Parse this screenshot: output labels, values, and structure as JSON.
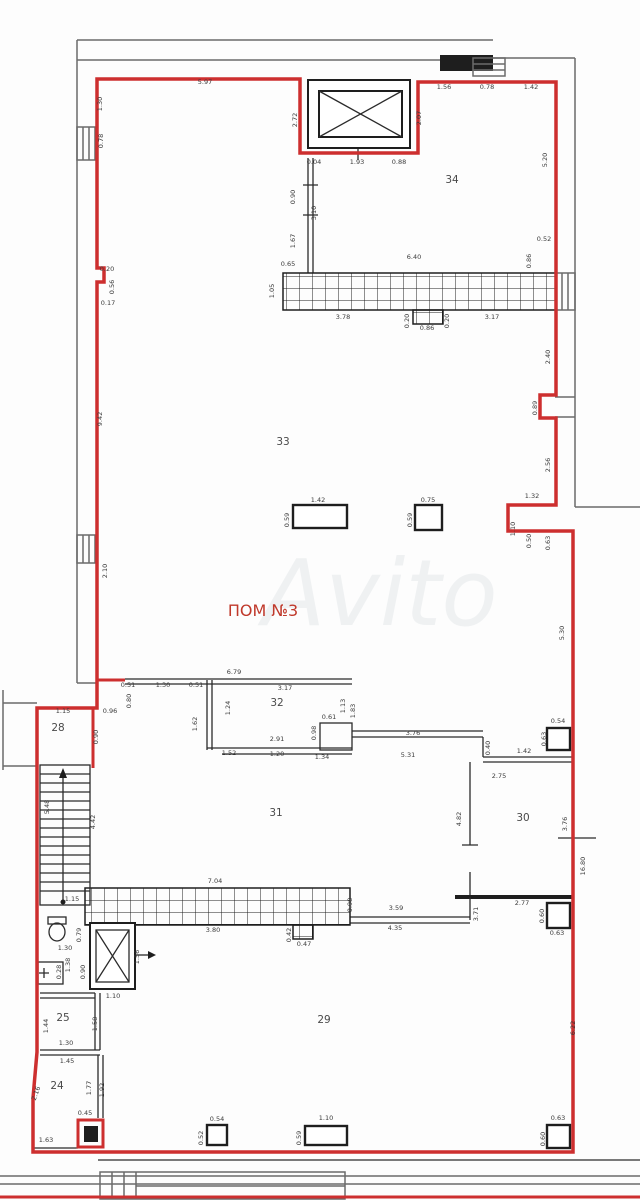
{
  "plan": {
    "title": "ПОМ №3",
    "watermark": "Avito",
    "colors": {
      "boundary": "#cd2f2f",
      "walls": "#2b2b2b",
      "outer": "#6b6b6b"
    },
    "rooms": [
      "24",
      "25",
      "28",
      "29",
      "30",
      "31",
      "32",
      "33",
      "34"
    ],
    "labels": [
      {
        "t": "5.97",
        "x": 205,
        "y": 84
      },
      {
        "t": "1.30",
        "x": 102,
        "y": 104,
        "r": -90
      },
      {
        "t": "0.78",
        "x": 103,
        "y": 141,
        "r": -90
      },
      {
        "t": "2.72",
        "x": 297,
        "y": 120,
        "r": -90
      },
      {
        "t": "1.56",
        "x": 444,
        "y": 89
      },
      {
        "t": "0.78",
        "x": 487,
        "y": 89
      },
      {
        "t": "1.42",
        "x": 531,
        "y": 89
      },
      {
        "t": "2.07",
        "x": 421,
        "y": 118,
        "r": -90
      },
      {
        "t": "0.04",
        "x": 314,
        "y": 164
      },
      {
        "t": "1.93",
        "x": 357,
        "y": 164
      },
      {
        "t": "0.88",
        "x": 399,
        "y": 164
      },
      {
        "t": "34",
        "x": 452,
        "y": 183,
        "kind": "room"
      },
      {
        "t": "5.20",
        "x": 547,
        "y": 160,
        "r": -90
      },
      {
        "t": "0.90",
        "x": 295,
        "y": 197,
        "r": -90
      },
      {
        "t": "3.10",
        "x": 316,
        "y": 213,
        "r": -90
      },
      {
        "t": "1.67",
        "x": 295,
        "y": 241,
        "r": -90
      },
      {
        "t": "0.65",
        "x": 288,
        "y": 266
      },
      {
        "t": "6.40",
        "x": 414,
        "y": 259
      },
      {
        "t": "0.86",
        "x": 531,
        "y": 261,
        "r": -90
      },
      {
        "t": "0.52",
        "x": 544,
        "y": 241
      },
      {
        "t": "1.05",
        "x": 274,
        "y": 291,
        "r": -90
      },
      {
        "t": "3.78",
        "x": 343,
        "y": 319
      },
      {
        "t": "0.20",
        "x": 409,
        "y": 321,
        "r": -90
      },
      {
        "t": "0.20",
        "x": 449,
        "y": 321,
        "r": -90
      },
      {
        "t": "0.86",
        "x": 427,
        "y": 330
      },
      {
        "t": "3.17",
        "x": 492,
        "y": 319
      },
      {
        "t": "2.40",
        "x": 550,
        "y": 357,
        "r": -90
      },
      {
        "t": "0.20",
        "x": 107,
        "y": 271
      },
      {
        "t": "0.56",
        "x": 114,
        "y": 287,
        "r": -90
      },
      {
        "t": "0.17",
        "x": 108,
        "y": 305
      },
      {
        "t": "9.42",
        "x": 102,
        "y": 419,
        "r": -90
      },
      {
        "t": "33",
        "x": 283,
        "y": 445,
        "kind": "room"
      },
      {
        "t": "1.42",
        "x": 318,
        "y": 502
      },
      {
        "t": "0.59",
        "x": 289,
        "y": 520,
        "r": -90
      },
      {
        "t": "0.75",
        "x": 428,
        "y": 502
      },
      {
        "t": "0.59",
        "x": 412,
        "y": 520,
        "r": -90
      },
      {
        "t": "0.89",
        "x": 537,
        "y": 408,
        "r": -90
      },
      {
        "t": "2.56",
        "x": 550,
        "y": 465,
        "r": -90
      },
      {
        "t": "1.32",
        "x": 532,
        "y": 498
      },
      {
        "t": "1.10",
        "x": 515,
        "y": 529,
        "r": -90
      },
      {
        "t": "0.50",
        "x": 531,
        "y": 541,
        "r": -90
      },
      {
        "t": "0.63",
        "x": 550,
        "y": 543,
        "r": -90
      },
      {
        "t": "2.10",
        "x": 107,
        "y": 571,
        "r": -90
      },
      {
        "t": "5.30",
        "x": 564,
        "y": 633,
        "r": -90
      },
      {
        "t": "6.79",
        "x": 234,
        "y": 674
      },
      {
        "t": "0.51",
        "x": 128,
        "y": 687
      },
      {
        "t": "1.30",
        "x": 163,
        "y": 687
      },
      {
        "t": "0.51",
        "x": 196,
        "y": 687
      },
      {
        "t": "0.80",
        "x": 131,
        "y": 701,
        "r": -90
      },
      {
        "t": "1.15",
        "x": 63,
        "y": 713
      },
      {
        "t": "28",
        "x": 58,
        "y": 731,
        "kind": "room"
      },
      {
        "t": "0.96",
        "x": 110,
        "y": 713
      },
      {
        "t": "0.90",
        "x": 98,
        "y": 737,
        "r": -90
      },
      {
        "t": "1.62",
        "x": 197,
        "y": 724,
        "r": -90
      },
      {
        "t": "1.24",
        "x": 230,
        "y": 708,
        "r": -90
      },
      {
        "t": "32",
        "x": 277,
        "y": 706,
        "kind": "room"
      },
      {
        "t": "3.17",
        "x": 285,
        "y": 690
      },
      {
        "t": "0.61",
        "x": 329,
        "y": 719
      },
      {
        "t": "1.13",
        "x": 345,
        "y": 706,
        "r": -90
      },
      {
        "t": "1.83",
        "x": 355,
        "y": 711,
        "r": -90
      },
      {
        "t": "0.98",
        "x": 316,
        "y": 733,
        "r": -90
      },
      {
        "t": "2.91",
        "x": 277,
        "y": 741
      },
      {
        "t": "1.52",
        "x": 229,
        "y": 755
      },
      {
        "t": "1.20",
        "x": 277,
        "y": 756
      },
      {
        "t": "1.34",
        "x": 322,
        "y": 759
      },
      {
        "t": "3.76",
        "x": 413,
        "y": 735
      },
      {
        "t": "5.31",
        "x": 408,
        "y": 757
      },
      {
        "t": "0.40",
        "x": 490,
        "y": 748,
        "r": -90
      },
      {
        "t": "1.42",
        "x": 524,
        "y": 753
      },
      {
        "t": "0.54",
        "x": 558,
        "y": 723
      },
      {
        "t": "0.63",
        "x": 546,
        "y": 739,
        "r": -90
      },
      {
        "t": "2.75",
        "x": 499,
        "y": 778
      },
      {
        "t": "16.80",
        "x": 585,
        "y": 866,
        "r": -90
      },
      {
        "t": "3.76",
        "x": 567,
        "y": 824,
        "r": -90
      },
      {
        "t": "30",
        "x": 523,
        "y": 821,
        "kind": "room"
      },
      {
        "t": "4.82",
        "x": 461,
        "y": 819,
        "r": -90
      },
      {
        "t": "31",
        "x": 276,
        "y": 816,
        "kind": "room"
      },
      {
        "t": "5.48",
        "x": 49,
        "y": 807,
        "r": -90
      },
      {
        "t": "4.42",
        "x": 95,
        "y": 822,
        "r": -90
      },
      {
        "t": "1.15",
        "x": 72,
        "y": 901
      },
      {
        "t": "7.04",
        "x": 215,
        "y": 883
      },
      {
        "t": "3.80",
        "x": 213,
        "y": 932
      },
      {
        "t": "0.42",
        "x": 291,
        "y": 935,
        "r": -90
      },
      {
        "t": "0.47",
        "x": 304,
        "y": 946
      },
      {
        "t": "0.98",
        "x": 352,
        "y": 905,
        "r": -90
      },
      {
        "t": "3.59",
        "x": 396,
        "y": 910
      },
      {
        "t": "4.35",
        "x": 395,
        "y": 930
      },
      {
        "t": "2.77",
        "x": 522,
        "y": 905
      },
      {
        "t": "3.71",
        "x": 478,
        "y": 914,
        "r": -90
      },
      {
        "t": "0.60",
        "x": 544,
        "y": 916,
        "r": -90
      },
      {
        "t": "0.63",
        "x": 557,
        "y": 935
      },
      {
        "t": "0.79",
        "x": 81,
        "y": 935,
        "r": -90
      },
      {
        "t": "1.30",
        "x": 65,
        "y": 950
      },
      {
        "t": "1.38",
        "x": 70,
        "y": 965,
        "r": -90
      },
      {
        "t": "0.28",
        "x": 61,
        "y": 972,
        "r": -90
      },
      {
        "t": "0.90",
        "x": 85,
        "y": 972,
        "r": -90
      },
      {
        "t": "1.56",
        "x": 139,
        "y": 957,
        "r": -90
      },
      {
        "t": "1.10",
        "x": 113,
        "y": 998
      },
      {
        "t": "25",
        "x": 63,
        "y": 1021,
        "kind": "room"
      },
      {
        "t": "1.44",
        "x": 48,
        "y": 1026,
        "r": -90
      },
      {
        "t": "1.58",
        "x": 97,
        "y": 1024,
        "r": -90
      },
      {
        "t": "1.30",
        "x": 66,
        "y": 1045
      },
      {
        "t": "1.45",
        "x": 67,
        "y": 1063
      },
      {
        "t": "24",
        "x": 57,
        "y": 1089,
        "kind": "room"
      },
      {
        "t": "2.16",
        "x": 38,
        "y": 1094,
        "r": -70
      },
      {
        "t": "1.77",
        "x": 91,
        "y": 1088,
        "r": -90
      },
      {
        "t": "1.92",
        "x": 104,
        "y": 1090,
        "r": -90
      },
      {
        "t": "0.45",
        "x": 85,
        "y": 1115
      },
      {
        "t": "1.63",
        "x": 46,
        "y": 1142
      },
      {
        "t": "29",
        "x": 324,
        "y": 1023,
        "kind": "room"
      },
      {
        "t": "6.22",
        "x": 575,
        "y": 1028,
        "r": -90
      },
      {
        "t": "0.54",
        "x": 217,
        "y": 1121
      },
      {
        "t": "0.52",
        "x": 203,
        "y": 1138,
        "r": -90
      },
      {
        "t": "1.10",
        "x": 326,
        "y": 1120
      },
      {
        "t": "0.59",
        "x": 301,
        "y": 1138,
        "r": -90
      },
      {
        "t": "0.63",
        "x": 558,
        "y": 1120
      },
      {
        "t": "0.60",
        "x": 545,
        "y": 1139,
        "r": -90
      }
    ]
  }
}
